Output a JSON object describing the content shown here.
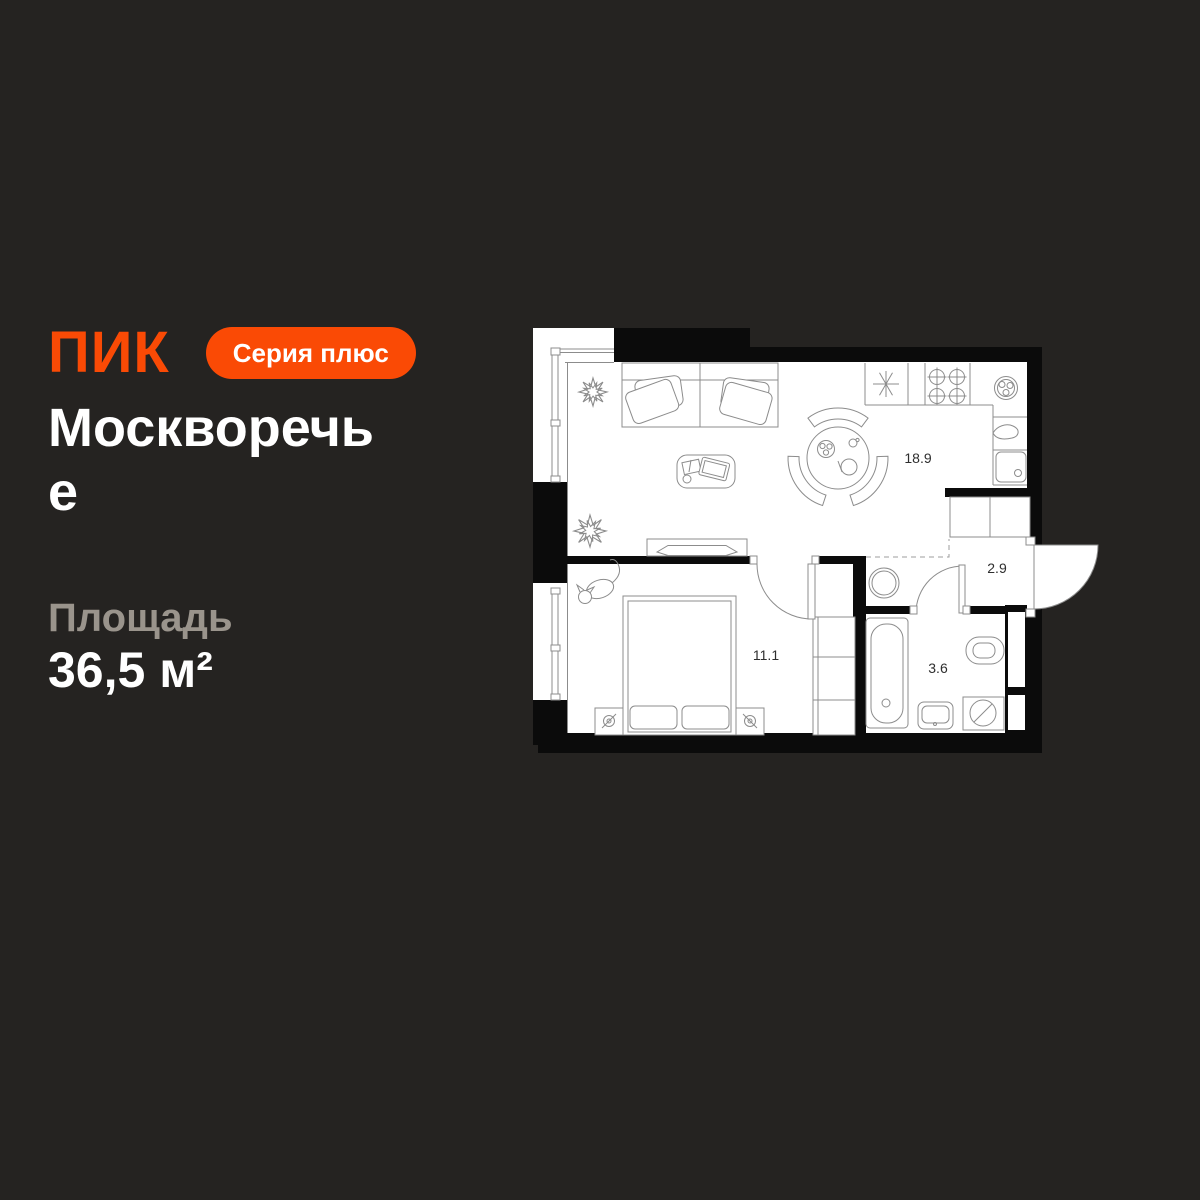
{
  "background": "#252321",
  "brand": {
    "logo_text": "ПИК",
    "badge_label": "Серия плюс",
    "accent_color": "#fa4a05"
  },
  "project": {
    "title": "Москворечье"
  },
  "area": {
    "label": "Площадь",
    "value": "36,5 м²"
  },
  "floor_plan": {
    "rooms": [
      {
        "name": "kitchen-living-room",
        "label": "18.9"
      },
      {
        "name": "hallway",
        "label": "2.9"
      },
      {
        "name": "bedroom",
        "label": "11.1"
      },
      {
        "name": "bathroom",
        "label": "3.6"
      }
    ]
  }
}
